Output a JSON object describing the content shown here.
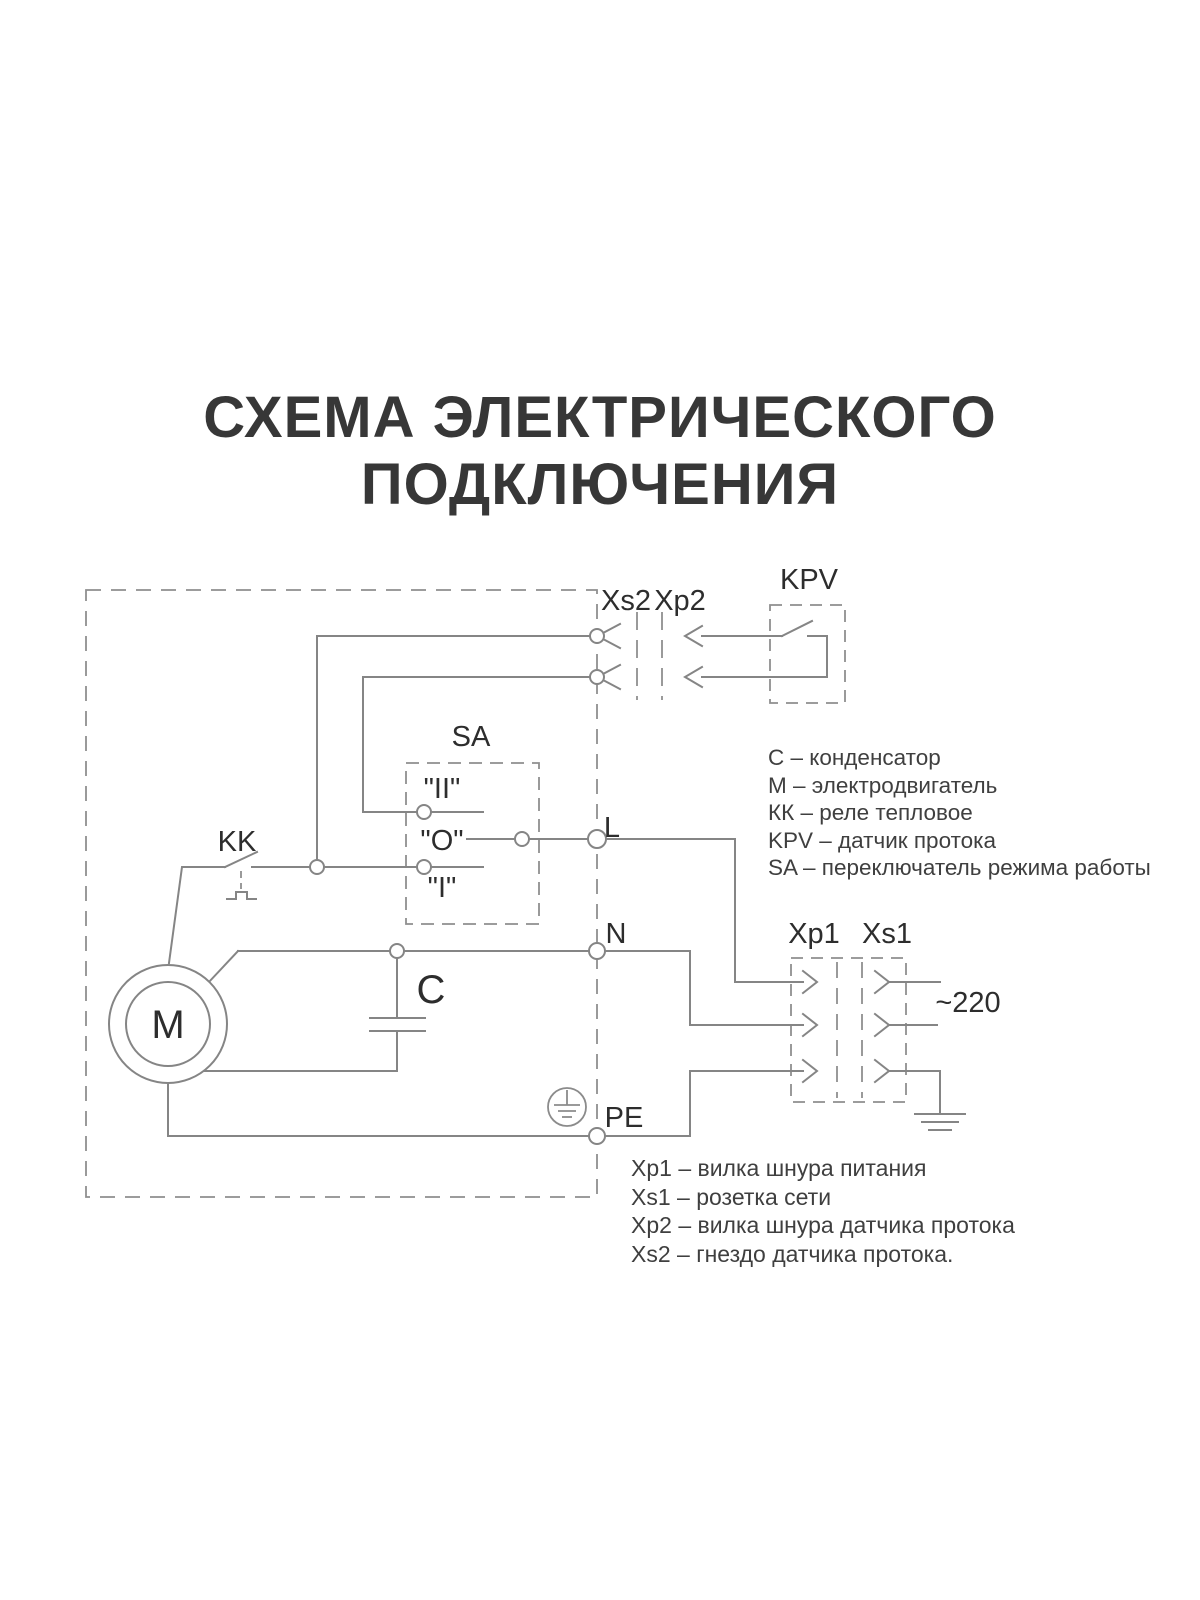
{
  "title": {
    "line1": "СХЕМА ЭЛЕКТРИЧЕСКОГО",
    "line2": "ПОДКЛЮЧЕНИЯ"
  },
  "diagram": {
    "labels": {
      "xs2": "Xs2",
      "xp2": "Xp2",
      "kpv": "KPV",
      "sa": "SA",
      "kk": "KK",
      "l": "L",
      "n": "N",
      "pe": "PE",
      "xp1": "Xp1",
      "xs1": "Xs1",
      "voltage": "~220",
      "motor": "M",
      "capacitor": "C",
      "pos_ii": "\"II\"",
      "pos_o": "\"O\"",
      "pos_i": "\"I\""
    },
    "colors": {
      "wire": "#858585",
      "label": "#2d2d2d",
      "title": "#373737",
      "legend": "#3f3f3f"
    }
  },
  "legend_components": {
    "items": [
      "С – конденсатор",
      "М – электродвигатель",
      "КК – реле тепловое",
      "KPV – датчик протока",
      "SA – переключатель режима работы"
    ]
  },
  "legend_connectors": {
    "items": [
      "Xp1 – вилка шнура питания",
      "Xs1 – розетка сети",
      "Xp2 – вилка шнура датчика протока",
      "Xs2 – гнездо датчика протока."
    ]
  }
}
